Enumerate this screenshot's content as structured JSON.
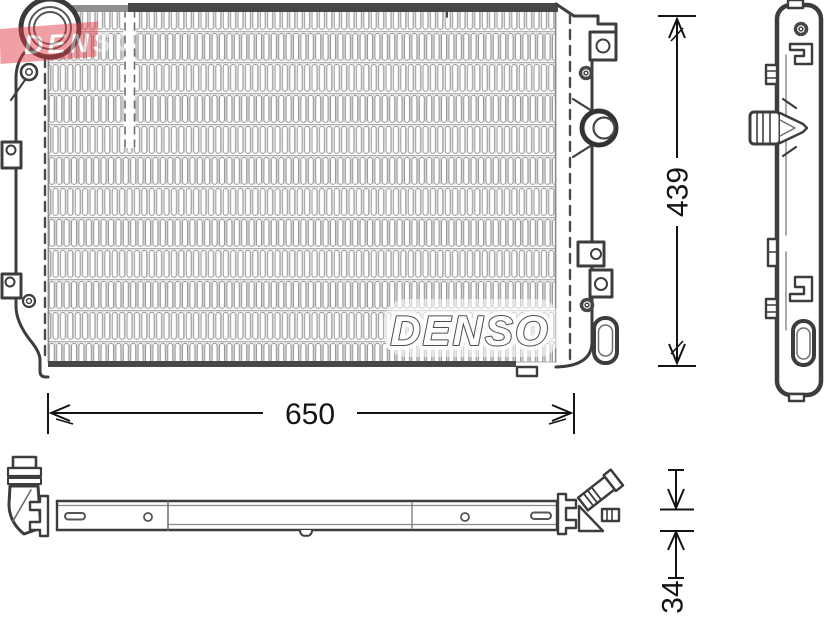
{
  "watermark": {
    "text": "DENSO",
    "color": "#e03a42"
  },
  "radiator": {
    "brand_label": "DENSO"
  },
  "dimensions": {
    "width": "650",
    "height": "439",
    "depth": "34"
  },
  "colors": {
    "line": "#3d3d3d",
    "dark_bar": "#474747",
    "fin": "#949494"
  }
}
